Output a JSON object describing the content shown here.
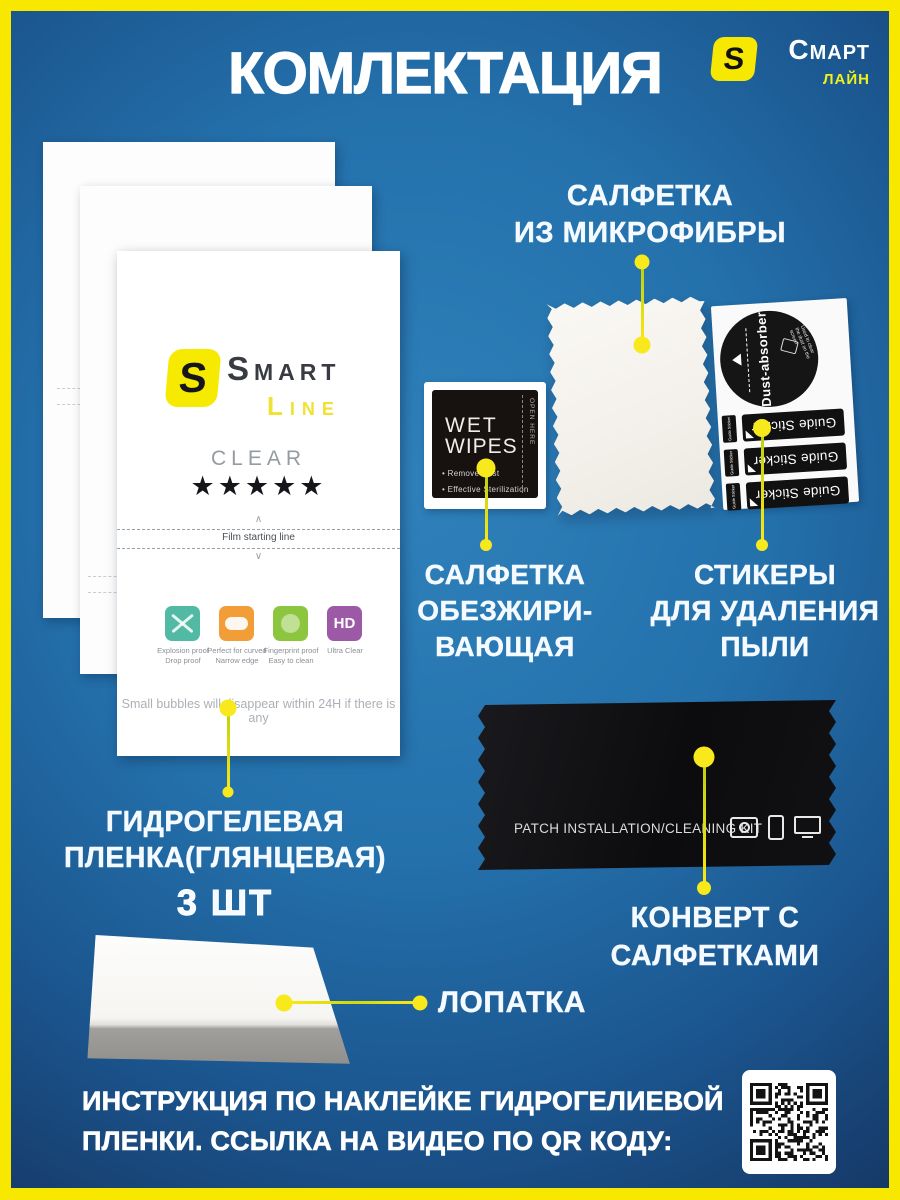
{
  "title": "КОМЛЕКТАЦИЯ",
  "brand": {
    "s": "S",
    "name1": "Смарт",
    "name2": "лайн"
  },
  "film": {
    "s": "S",
    "smart": "Smart",
    "line": "Line",
    "clear": "CLEAR",
    "stars": "★★★★★",
    "chev_up": "∧",
    "chev_dn": "∨",
    "start_line": "Film starting line",
    "features": [
      {
        "cap1": "Explosion proof",
        "cap2": "Drop proof",
        "color": "#52b9a4"
      },
      {
        "cap1": "Perfect for curved",
        "cap2": "Narrow edge",
        "color": "#f29d38"
      },
      {
        "cap1": "Fingerprint proof",
        "cap2": "Easy to clean",
        "color": "#8cc63f"
      },
      {
        "cap1": "Ultra Clear",
        "cap2": "",
        "color": "#9b59a6",
        "glyph": "HD"
      }
    ],
    "bubbles": "Small bubbles will disappear within 24H if there is any"
  },
  "wipes": {
    "w1": "WET",
    "w2": "WIPES",
    "b1": "• Remove Dust",
    "b2": "• Effective Sterilization",
    "side": "OPEN HERE"
  },
  "stickers": {
    "circle": "Dust-absorber",
    "note": "Used to clear the dust on the screen",
    "strip": "Guide Sticker",
    "tab": "Guide Sticker"
  },
  "envelope": {
    "label": "PATCH INSTALLATION/CLEANING KIT"
  },
  "labels": {
    "microfiber": [
      "САЛФЕТКА",
      "ИЗ МИКРОФИБРЫ"
    ],
    "degreasing": [
      "САЛФЕТКА",
      "ОБЕЗЖИРИ-",
      "ВАЮЩАЯ"
    ],
    "stickers": [
      "СТИКЕРЫ",
      "ДЛЯ УДАЛЕНИЯ",
      "ПЫЛИ"
    ],
    "film": [
      "ГИДРОГЕЛЕВАЯ",
      "ПЛЕНКА(ГЛЯНЦЕВАЯ)"
    ],
    "film_qty": "3 ШТ",
    "envelope": [
      "КОНВЕРТ С",
      "САЛФЕТКАМИ"
    ],
    "spatula": "ЛОПАТКА"
  },
  "footer": [
    "ИНСТРУКЦИЯ ПО НАКЛЕЙКЕ ГИДРОГЕЛИЕВОЙ",
    "ПЛЕНКИ. ССЫЛКА НА ВИДЕО ПО  QR КОДУ:"
  ],
  "colors": {
    "frame_yellow": "#f8e800",
    "background_blue": "#2273ae",
    "accent_dot_yellow": "#f8e91c",
    "logo_yellow": "#f6ea00",
    "feature_teal": "#52b9a4",
    "feature_orange": "#f29d38",
    "feature_green": "#8cc63f",
    "feature_purple": "#9b59a6"
  }
}
